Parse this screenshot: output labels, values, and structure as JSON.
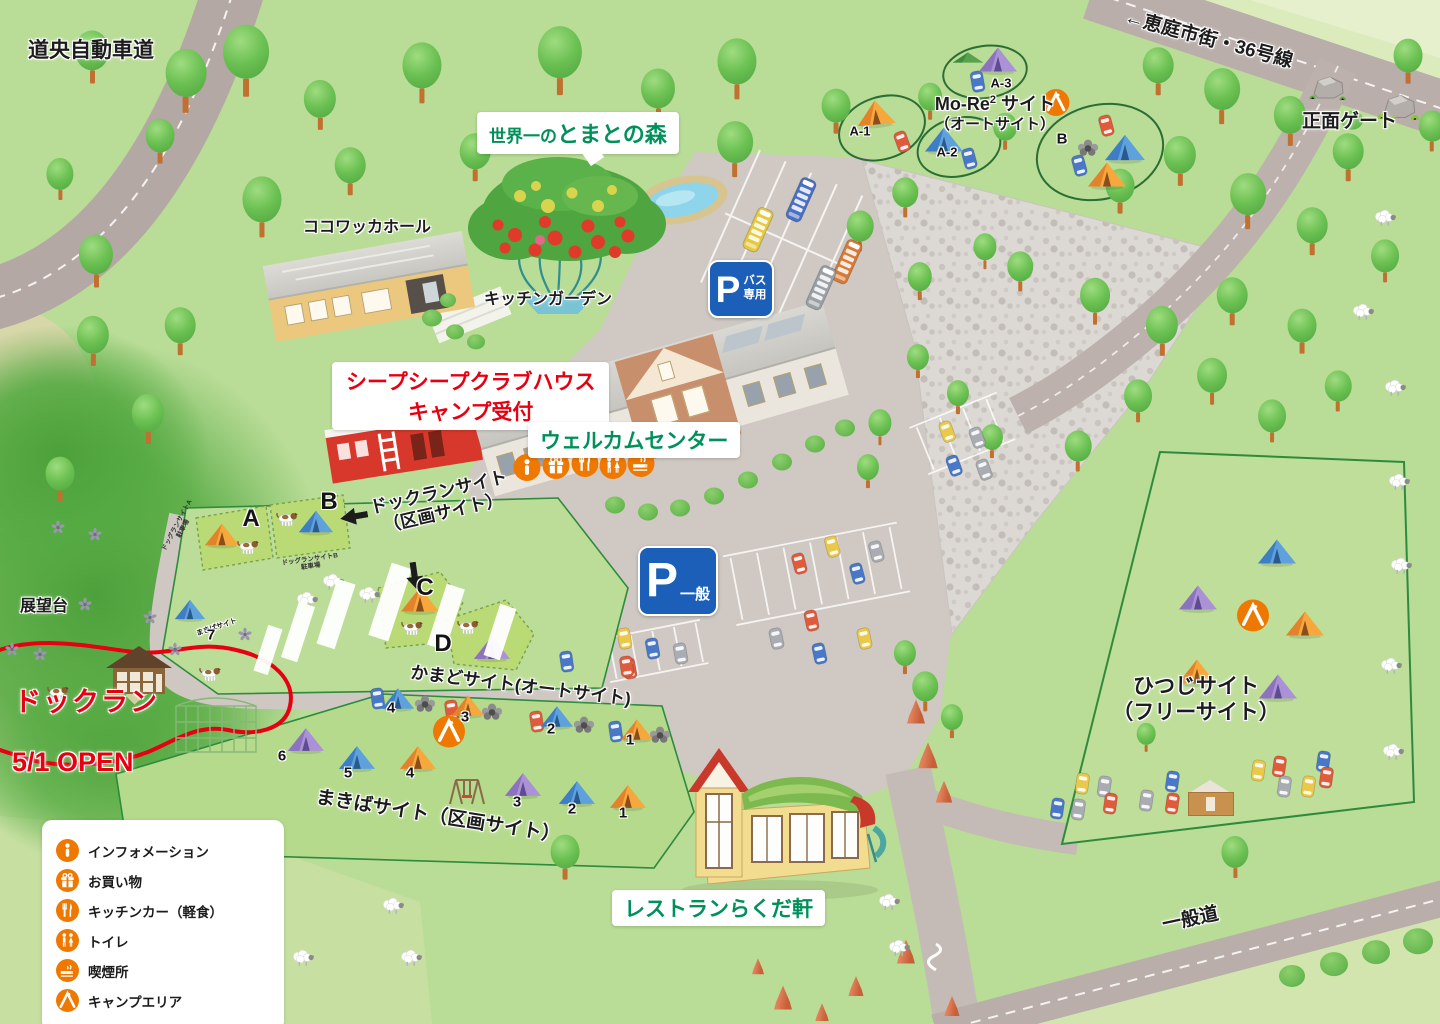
{
  "roads": {
    "expressway": "道央自動車道",
    "route36": "←恵庭市街・36号線",
    "general": "一般道",
    "front_gate": "正面ゲート"
  },
  "places": {
    "cocowakka": "ココワッカホール",
    "tomato_prefix": "世界一の",
    "tomato_name": "とまとの森",
    "kitchen_garden": "キッチンガーデン",
    "clubhouse_line1": "シープシープクラブハウス",
    "clubhouse_line2": "キャンプ受付",
    "welcome_center": "ウェルカムセンター",
    "restaurant": "レストランらくだ軒",
    "observatory": "展望台"
  },
  "parking": {
    "p": "P",
    "bus_line1": "バス",
    "bus_line2": "専用",
    "general": "一般"
  },
  "sites": {
    "more2": {
      "name_en": "Mo-Re",
      "sup": "2",
      "name_suffix": " サイト",
      "subtitle": "（オートサイト）",
      "spots": [
        "A-1",
        "A-2",
        "A-3",
        "B"
      ]
    },
    "dogrun": {
      "line1": "ドックランサイト",
      "line2": "（区画サイト）",
      "spots": [
        "A",
        "B",
        "C",
        "D"
      ],
      "parking_a1": "ドッグランサイトA",
      "parking_a2": "駐車場",
      "parking_b1": "ドッグランサイトB",
      "parking_b2": "駐車場"
    },
    "kamado": {
      "label": "かまどサイト(オートサイト)",
      "spots": [
        "1",
        "2",
        "3",
        "4"
      ]
    },
    "makiba": {
      "label": "まきばサイト（区画サイト）",
      "small": "まきばサイト",
      "spots": [
        "1",
        "2",
        "3",
        "4",
        "5",
        "6",
        "7"
      ]
    },
    "hitsuji": {
      "line1": "ひつじサイト",
      "line2": "（フリーサイト）"
    }
  },
  "dogrun_area": {
    "name": "ドックラン",
    "open": "5/1 OPEN"
  },
  "legend": {
    "items": [
      {
        "icon": "information-icon",
        "label": "インフォメーション"
      },
      {
        "icon": "shopping-icon",
        "label": "お買い物"
      },
      {
        "icon": "kitchen-car-icon",
        "label": "キッチンカー（軽食）"
      },
      {
        "icon": "toilet-icon",
        "label": "トイレ"
      },
      {
        "icon": "smoking-icon",
        "label": "喫煙所"
      },
      {
        "icon": "camp-area-icon",
        "label": "キャンプエリア"
      }
    ]
  },
  "colors": {
    "accent_orange": "#ee7800",
    "sign_blue": "#1b5fb8",
    "heading_green": "#00915a",
    "alert_red": "#e60012",
    "site_outline": "#2e8b3d"
  }
}
